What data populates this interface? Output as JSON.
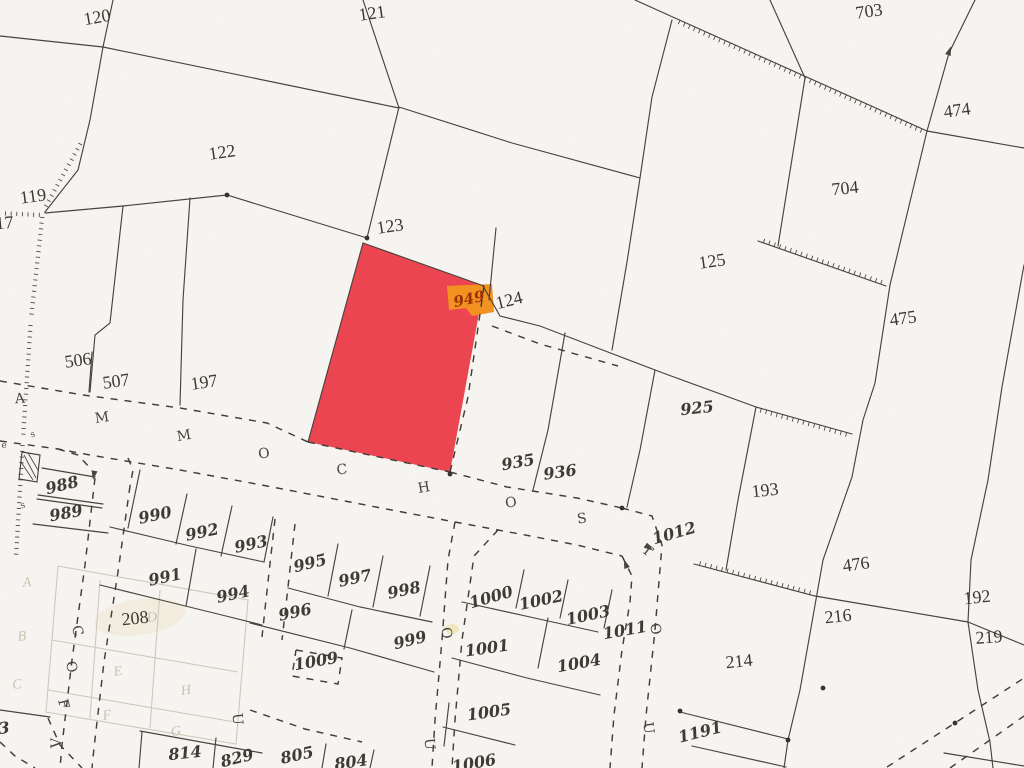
{
  "map": {
    "highlight": {
      "parcel_fill": "#ee4350",
      "tag_text": "949",
      "tag_fill": "#f6921e",
      "tag_text_color": "#9c2d06"
    },
    "parcel_labels": [
      {
        "t": "120",
        "x": 97,
        "y": 17,
        "r": -10,
        "s": "print"
      },
      {
        "t": "121",
        "x": 372,
        "y": 13,
        "r": -8,
        "s": "print"
      },
      {
        "t": "703",
        "x": 869,
        "y": 11,
        "r": -8,
        "s": "print"
      },
      {
        "t": "474",
        "x": 957,
        "y": 110,
        "r": -8,
        "s": "print"
      },
      {
        "t": "122",
        "x": 222,
        "y": 152,
        "r": -8,
        "s": "print"
      },
      {
        "t": "704",
        "x": 845,
        "y": 188,
        "r": -6,
        "s": "print"
      },
      {
        "t": "119",
        "x": 33,
        "y": 196,
        "r": -8,
        "s": "print"
      },
      {
        "t": "917",
        "x": 0,
        "y": 223,
        "r": -5,
        "s": "print"
      },
      {
        "t": "123",
        "x": 390,
        "y": 226,
        "r": -8,
        "s": "print"
      },
      {
        "t": "125",
        "x": 712,
        "y": 261,
        "r": -8,
        "s": "print"
      },
      {
        "t": "475",
        "x": 903,
        "y": 318,
        "r": -8,
        "s": "print"
      },
      {
        "t": "124",
        "x": 509,
        "y": 300,
        "r": -14,
        "s": "print"
      },
      {
        "t": "506",
        "x": 78,
        "y": 360,
        "r": -8,
        "s": "print"
      },
      {
        "t": "507",
        "x": 116,
        "y": 381,
        "r": -8,
        "s": "print"
      },
      {
        "t": "197",
        "x": 204,
        "y": 382,
        "r": -8,
        "s": "print"
      },
      {
        "t": "193",
        "x": 765,
        "y": 490,
        "r": -6,
        "s": "print"
      },
      {
        "t": "476",
        "x": 856,
        "y": 564,
        "r": -8,
        "s": "print"
      },
      {
        "t": "216",
        "x": 838,
        "y": 616,
        "r": -6,
        "s": "print"
      },
      {
        "t": "192",
        "x": 977,
        "y": 597,
        "r": -6,
        "s": "print"
      },
      {
        "t": "219",
        "x": 989,
        "y": 637,
        "r": -4,
        "s": "print"
      },
      {
        "t": "214",
        "x": 739,
        "y": 661,
        "r": -6,
        "s": "print"
      },
      {
        "t": "208",
        "x": 135,
        "y": 618,
        "r": -6,
        "s": "print"
      },
      {
        "t": "925",
        "x": 697,
        "y": 408,
        "r": -6,
        "s": "hand"
      },
      {
        "t": "935",
        "x": 518,
        "y": 462,
        "r": -10,
        "s": "hand"
      },
      {
        "t": "936",
        "x": 560,
        "y": 472,
        "r": -8,
        "s": "hand"
      },
      {
        "t": "988",
        "x": 62,
        "y": 485,
        "r": -14,
        "s": "hand"
      },
      {
        "t": "989",
        "x": 66,
        "y": 513,
        "r": -10,
        "s": "hand"
      },
      {
        "t": "990",
        "x": 155,
        "y": 515,
        "r": -12,
        "s": "hand"
      },
      {
        "t": "992",
        "x": 202,
        "y": 532,
        "r": -12,
        "s": "hand"
      },
      {
        "t": "993",
        "x": 251,
        "y": 544,
        "r": -12,
        "s": "hand"
      },
      {
        "t": "995",
        "x": 310,
        "y": 563,
        "r": -14,
        "s": "hand"
      },
      {
        "t": "997",
        "x": 355,
        "y": 578,
        "r": -12,
        "s": "hand"
      },
      {
        "t": "998",
        "x": 404,
        "y": 590,
        "r": -12,
        "s": "hand"
      },
      {
        "t": "991",
        "x": 165,
        "y": 577,
        "r": -12,
        "s": "hand"
      },
      {
        "t": "994",
        "x": 233,
        "y": 594,
        "r": -12,
        "s": "hand"
      },
      {
        "t": "996",
        "x": 295,
        "y": 612,
        "r": -12,
        "s": "hand"
      },
      {
        "t": "999",
        "x": 410,
        "y": 640,
        "r": -14,
        "s": "hand"
      },
      {
        "t": "1000",
        "x": 491,
        "y": 597,
        "r": -16,
        "s": "hand"
      },
      {
        "t": "1002",
        "x": 541,
        "y": 600,
        "r": -12,
        "s": "hand"
      },
      {
        "t": "1003",
        "x": 588,
        "y": 615,
        "r": -12,
        "s": "hand"
      },
      {
        "t": "1011",
        "x": 625,
        "y": 630,
        "r": -10,
        "s": "hand"
      },
      {
        "t": "1012",
        "x": 674,
        "y": 533,
        "r": -16,
        "s": "hand"
      },
      {
        "t": "1009",
        "x": 316,
        "y": 661,
        "r": -10,
        "s": "hand"
      },
      {
        "t": "1001",
        "x": 487,
        "y": 648,
        "r": -8,
        "s": "hand"
      },
      {
        "t": "1004",
        "x": 579,
        "y": 663,
        "r": -10,
        "s": "hand"
      },
      {
        "t": "1005",
        "x": 489,
        "y": 712,
        "r": -8,
        "s": "hand"
      },
      {
        "t": "1006",
        "x": 474,
        "y": 763,
        "r": -10,
        "s": "hand"
      },
      {
        "t": "1191",
        "x": 700,
        "y": 732,
        "r": -14,
        "s": "hand"
      },
      {
        "t": "814",
        "x": 185,
        "y": 753,
        "r": -6,
        "s": "hand"
      },
      {
        "t": "829",
        "x": 237,
        "y": 758,
        "r": -14,
        "s": "hand"
      },
      {
        "t": "805",
        "x": 297,
        "y": 755,
        "r": -12,
        "s": "hand"
      },
      {
        "t": "804",
        "x": 351,
        "y": 762,
        "r": -8,
        "s": "hand"
      },
      {
        "t": "3",
        "x": 4,
        "y": 728,
        "r": -6,
        "s": "hand"
      }
    ],
    "street_letters": [
      {
        "t": "A",
        "x": 20,
        "y": 399,
        "r": -5
      },
      {
        "t": "M",
        "x": 102,
        "y": 418,
        "r": -8
      },
      {
        "t": "M",
        "x": 184,
        "y": 436,
        "r": -10
      },
      {
        "t": "O",
        "x": 264,
        "y": 454,
        "r": -8
      },
      {
        "t": "C",
        "x": 342,
        "y": 470,
        "r": -8
      },
      {
        "t": "H",
        "x": 424,
        "y": 488,
        "r": -10
      },
      {
        "t": "O",
        "x": 511,
        "y": 503,
        "r": -8
      },
      {
        "t": "S",
        "x": 582,
        "y": 519,
        "r": -8
      },
      {
        "t": "T",
        "x": 647,
        "y": 551,
        "r": 38
      },
      {
        "t": "O",
        "x": 655,
        "y": 629,
        "r": 78
      },
      {
        "t": "U",
        "x": 648,
        "y": 728,
        "r": 82
      },
      {
        "t": "O",
        "x": 446,
        "y": 633,
        "r": 82
      },
      {
        "t": "U",
        "x": 429,
        "y": 744,
        "r": 86
      },
      {
        "t": "C",
        "x": 77,
        "y": 631,
        "r": 72
      },
      {
        "t": "O",
        "x": 71,
        "y": 667,
        "r": 76
      },
      {
        "t": "F",
        "x": 63,
        "y": 704,
        "r": 76
      },
      {
        "t": "V",
        "x": 57,
        "y": 743,
        "r": -90
      },
      {
        "t": "U",
        "x": 237,
        "y": 719,
        "r": 85
      }
    ],
    "faint_letters": [
      {
        "t": "A",
        "x": 27,
        "y": 583,
        "r": -6
      },
      {
        "t": "B",
        "x": 22,
        "y": 637,
        "r": -6
      },
      {
        "t": "C",
        "x": 17,
        "y": 685,
        "r": -6
      },
      {
        "t": "E",
        "x": 118,
        "y": 672,
        "r": -8
      },
      {
        "t": "H",
        "x": 186,
        "y": 691,
        "r": -8
      },
      {
        "t": "F",
        "x": 107,
        "y": 716,
        "r": -8
      },
      {
        "t": "G",
        "x": 176,
        "y": 732,
        "r": -8
      },
      {
        "t": "D",
        "x": 152,
        "y": 618,
        "r": -8
      }
    ],
    "tiny_marks": [
      {
        "t": "s",
        "x": 33,
        "y": 435,
        "r": -20
      },
      {
        "t": "s",
        "x": 23,
        "y": 506,
        "r": -20
      },
      {
        "t": "e",
        "x": 4,
        "y": 446,
        "r": 0
      }
    ]
  }
}
